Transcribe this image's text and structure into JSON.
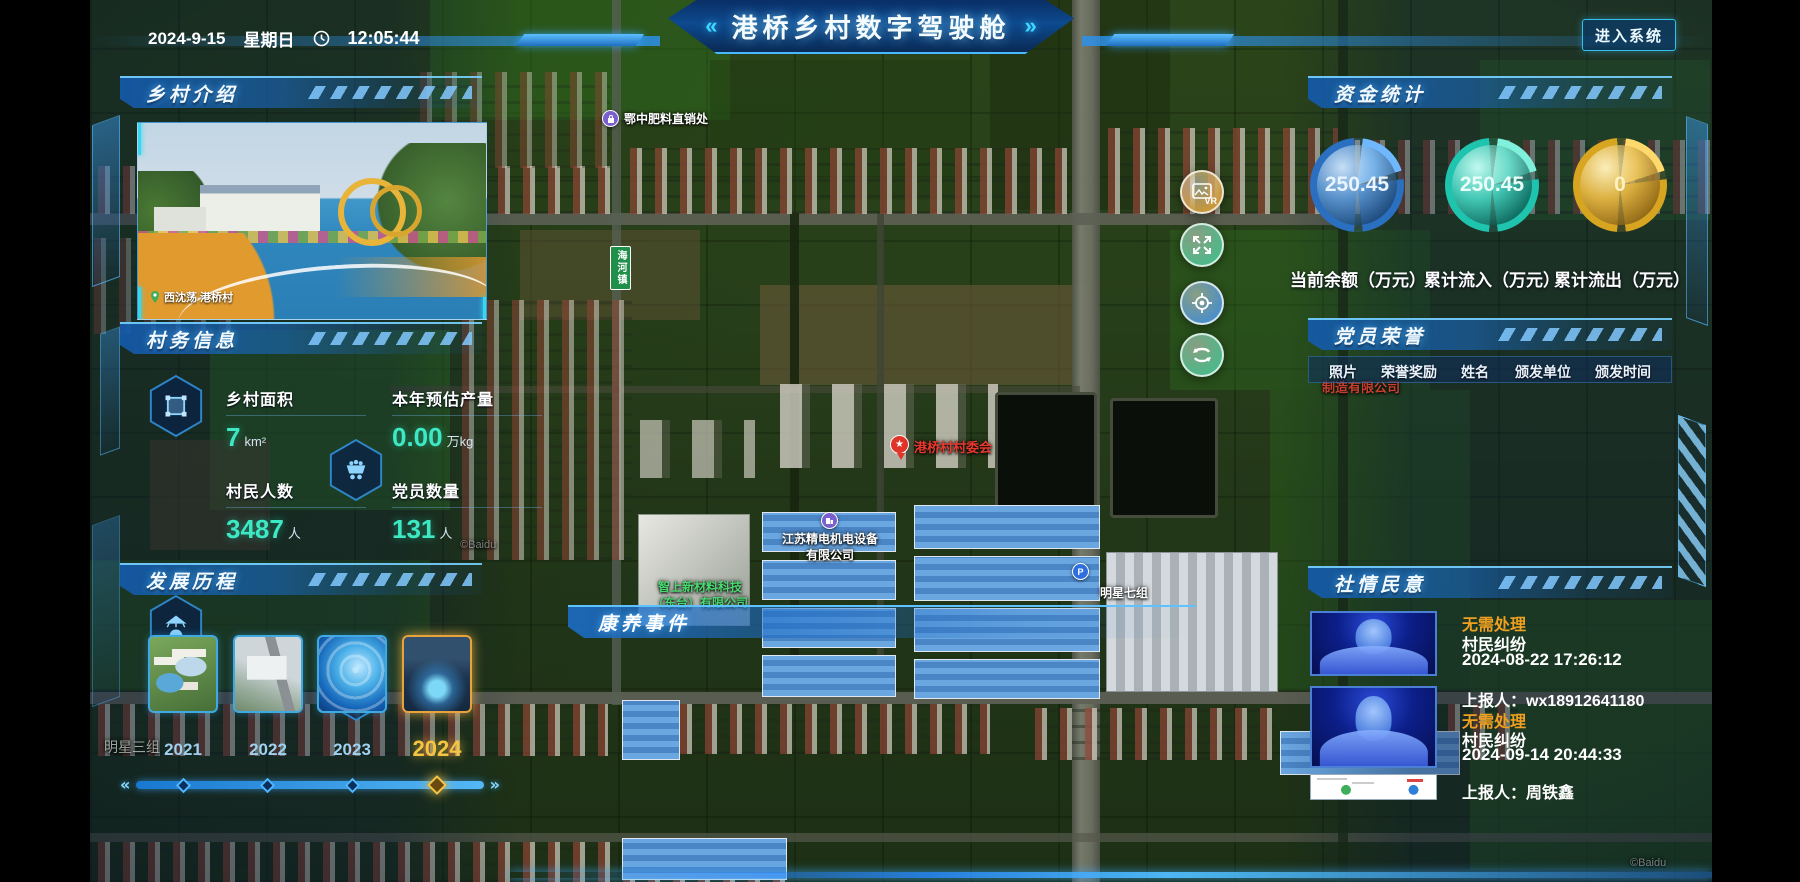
{
  "header": {
    "date": "2024-9-15",
    "weekday": "星期日",
    "time": "12:05:44",
    "title": "港桥乡村数字驾驶舱",
    "title_decor_left": "«",
    "title_decor_right": "»",
    "enter_button": "进入系统"
  },
  "intro_panel": {
    "title": "乡村介绍",
    "photo_caption": "西沈荡 港桥村"
  },
  "info_panel": {
    "title": "村务信息",
    "stats": [
      {
        "label": "乡村面积",
        "value": "7",
        "unit": "km²"
      },
      {
        "label": "本年预估产量",
        "value": "0.00",
        "unit": "万kg"
      },
      {
        "label": "村民人数",
        "value": "3487",
        "unit": "人"
      },
      {
        "label": "党员数量",
        "value": "131",
        "unit": "人"
      }
    ]
  },
  "history_panel": {
    "title": "发展历程",
    "years": [
      "2021",
      "2022",
      "2023",
      "2024"
    ],
    "active_year": "2024"
  },
  "funds_panel": {
    "title": "资金统计",
    "gauges": [
      {
        "value": "250.45",
        "label": "当前余额（万元）",
        "color": "#3d8fe0"
      },
      {
        "value": "250.45",
        "label": "累计流入（万元）",
        "color": "#35e0c8"
      },
      {
        "value": "0",
        "label": "累计流出（万元）",
        "color": "#e8b831"
      }
    ]
  },
  "honors_panel": {
    "title": "党员荣誉",
    "columns": [
      "照片",
      "荣誉奖励",
      "姓名",
      "颁发单位",
      "颁发时间"
    ]
  },
  "sentiment_panel": {
    "title": "社情民意",
    "items": [
      {
        "status": "无需处理",
        "type": "村民纠纷",
        "time": "2024-08-22 17:26:12",
        "reporter": "上报人：wx18912641180"
      },
      {
        "status": "无需处理",
        "type": "村民纠纷",
        "time": "2024-09-14 20:44:33",
        "reporter": "上报人：周铁鑫"
      }
    ]
  },
  "map_overlay": {
    "event_bar_title": "康养事件",
    "labels": {
      "fertilizer": "鄂中肥料直销处",
      "committee": "港桥村村委会",
      "jingdian": "江苏精电机电设备\n有限公司",
      "zhishang": "智上新材料科技\n（东台）有限公司",
      "mingxing7": "明星七组",
      "mingxing3": "明星三组",
      "haihe": "海河镇",
      "zhizao": "制造有限公司",
      "baidu": "©Baidu",
      "parking": "P",
      "vr": "VR"
    }
  }
}
